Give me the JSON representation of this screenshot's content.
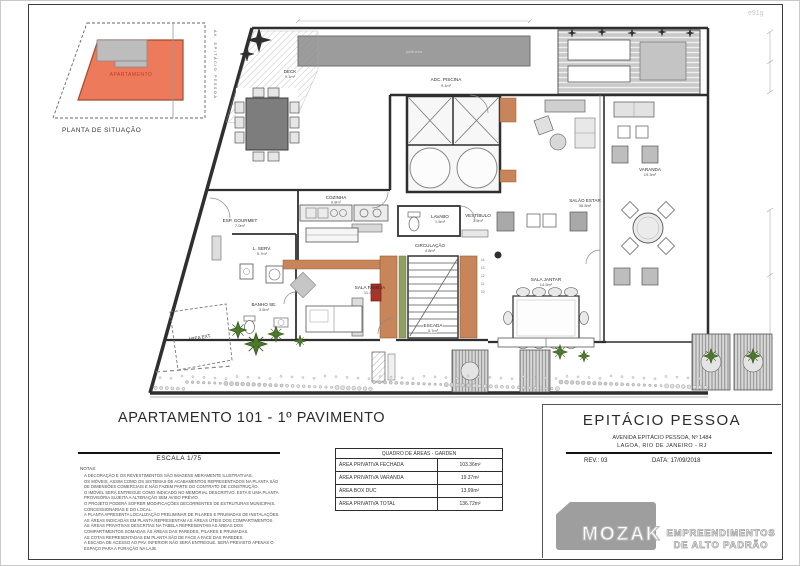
{
  "stamp": "e91g",
  "site_plan": {
    "caption": "PLANTA DE SITUAÇÃO",
    "unit_label": "APARTAMENTO",
    "street": "AV. EPITÁCIO PESSOA"
  },
  "plan": {
    "labels": {
      "jardineira": "jardineira",
      "adc_piscina": {
        "name": "ADC. PISCINA",
        "area": "9.1m²"
      },
      "deck": {
        "name": "DECK",
        "area": "9.1m²"
      },
      "esp_gourmet": {
        "name": "ESP. GOURMET",
        "area": "7.0m²"
      },
      "cozinha": {
        "name": "COZINHA",
        "area": "9.8m²"
      },
      "l_serv": {
        "name": "L. SERV.",
        "area": "5.7m²"
      },
      "lavabo": {
        "name": "LAVABO",
        "area": "1.5m²"
      },
      "vestibulo": {
        "name": "VESTÍBULO",
        "area": "3.5m²"
      },
      "circulacao": {
        "name": "CIRCULAÇÃO",
        "area": "4.8m²"
      },
      "salao_estar": {
        "name": "SALÃO ESTAR",
        "area": "36.8m²"
      },
      "sala_jantar": {
        "name": "SALA JANTAR",
        "area": "14.5m²"
      },
      "sala_familia": {
        "name": "SALA FAMÍLIA",
        "area": "11.4m²"
      },
      "escada": {
        "name": "ESCADA",
        "area": "5.7m²"
      },
      "banho": {
        "name": "BANHO SE.",
        "area": "3.5m²"
      },
      "varanda": {
        "name": "VARANDA",
        "area": "19.3m²"
      },
      "area_ext": {
        "name": "ÁREA EXT."
      },
      "stair_numbers": [
        "14",
        "13",
        "12",
        "11",
        "10"
      ]
    }
  },
  "headings": {
    "main_title": "APARTAMENTO 101 - 1º PAVIMENTO",
    "scale": "ESCALA 1/75",
    "notes_title": "NOTAS:"
  },
  "notes": [
    "A DECORAÇÃO E OS REVESTIMENTOS SÃO IMAGENS MERAMENTE ILUSTRATIVAS.",
    "OS MÓVEIS, ASSIM COMO OS SISTEMAS DE ACABAMENTOS REPRESENTADOS NA PLANTA SÃO",
    "DE DIMENSÕES COMERCIAIS E NÃO FAZEM PARTE DO CONTRATO DE CONSTRUÇÃO.",
    "O IMÓVEL SERÁ ENTREGUE COMO INDICADO NO MEMORIAL DESCRITIVO. ESTA É UMA PLANTA",
    "PROVISÓRIA SUJEITA A ALTERAÇÃO SEM AVISO PRÉVIO.",
    "O PROJETO PODERÁ SOFRER MODIFICAÇÕES DECORRENTES DE ESTRUTURAS MUNICIPAIS,",
    "CONCESSIONÁRIAS E DO LOCAL.",
    "A PLANTA APRESENTA LOCALIZAÇÃO PRELIMINAR DE PILARES E PRUMADAS DE INSTALAÇÕES.",
    "AS ÁREAS INDICADAS EM PLANTA REPRESENTAM AS ÁREAS ÚTEIS DOS COMPARTIMENTOS.",
    "AS ÁREAS PRIVATIVAS DESCRITAS NA TABELA REPRESENTAM AS ÁREAS DOS",
    "COMPARTIMENTOS SOMADAS ÀS ÁREAS DAS PAREDES, PILARES E PRUMADAS.",
    "AS COTAS REPRESENTADAS EM PLANTA SÃO DE FACE A FACE DAS PAREDES.",
    "A ESCADA DE ACESSO AO PAV. INFERIOR NÃO SERÁ ENTREGUE. SERÁ PREVISTO APENAS O",
    "ESPAÇO PARA A FURAÇÃO NA LAJE."
  ],
  "area_table": {
    "header": "QUADRO DE ÁREAS - GARDEN",
    "rows": [
      {
        "label": "ÁREA PRIVATIVA FECHADA",
        "value": "103.36m²"
      },
      {
        "label": "ÁREA PRIVATIVA VARANDA",
        "value": "19.37m²"
      },
      {
        "label": "ÁREA BOX DUC",
        "value": "13.99m²"
      },
      {
        "label": "ÁREA PRIVATIVA TOTAL",
        "value": "136.72m²"
      }
    ]
  },
  "title_block": {
    "project": "EPITÁCIO PESSOA",
    "address_line1": "AVENIDA EPITÁCIO PESSOA, Nº 1484",
    "address_line2": "LAGOA, RIO DE JANEIRO - RJ",
    "revision": "REV.: 03",
    "date": "DATA: 17/09/2018",
    "logo_text": "MOZAK",
    "logo_tagline1": "EMPREENDIMENTOS",
    "logo_tagline2": "DE ALTO PADRÃO"
  },
  "colors": {
    "wood": "#c8855a",
    "site_fill": "#ee7a5c",
    "wall": "#2f2f2f",
    "accent_red": "#a83326"
  }
}
